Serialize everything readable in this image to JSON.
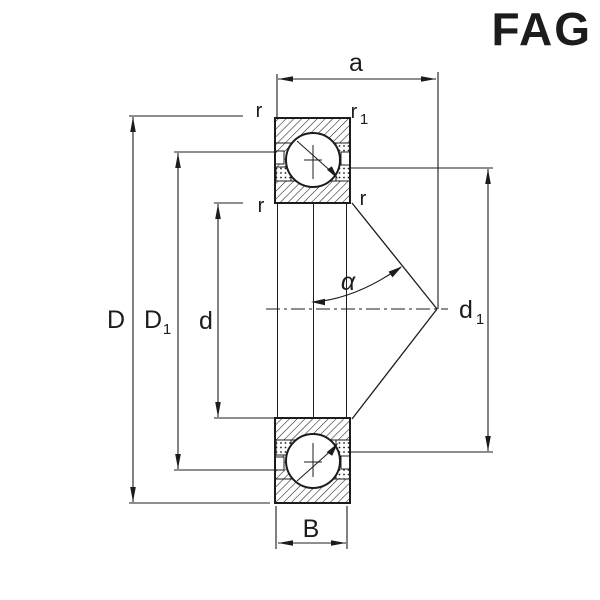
{
  "logo": {
    "text": "FAG",
    "color": "#DE0A26"
  },
  "colors": {
    "line": "#1c1c1c",
    "background": "#ffffff"
  },
  "labels": {
    "a": "a",
    "B": "B",
    "D": "D",
    "d": "d",
    "D1": {
      "main": "D",
      "sub": "1"
    },
    "d1": {
      "main": "d",
      "sub": "1"
    },
    "r1": {
      "main": "r",
      "sub": "1"
    },
    "r": "r",
    "alpha": "α"
  }
}
